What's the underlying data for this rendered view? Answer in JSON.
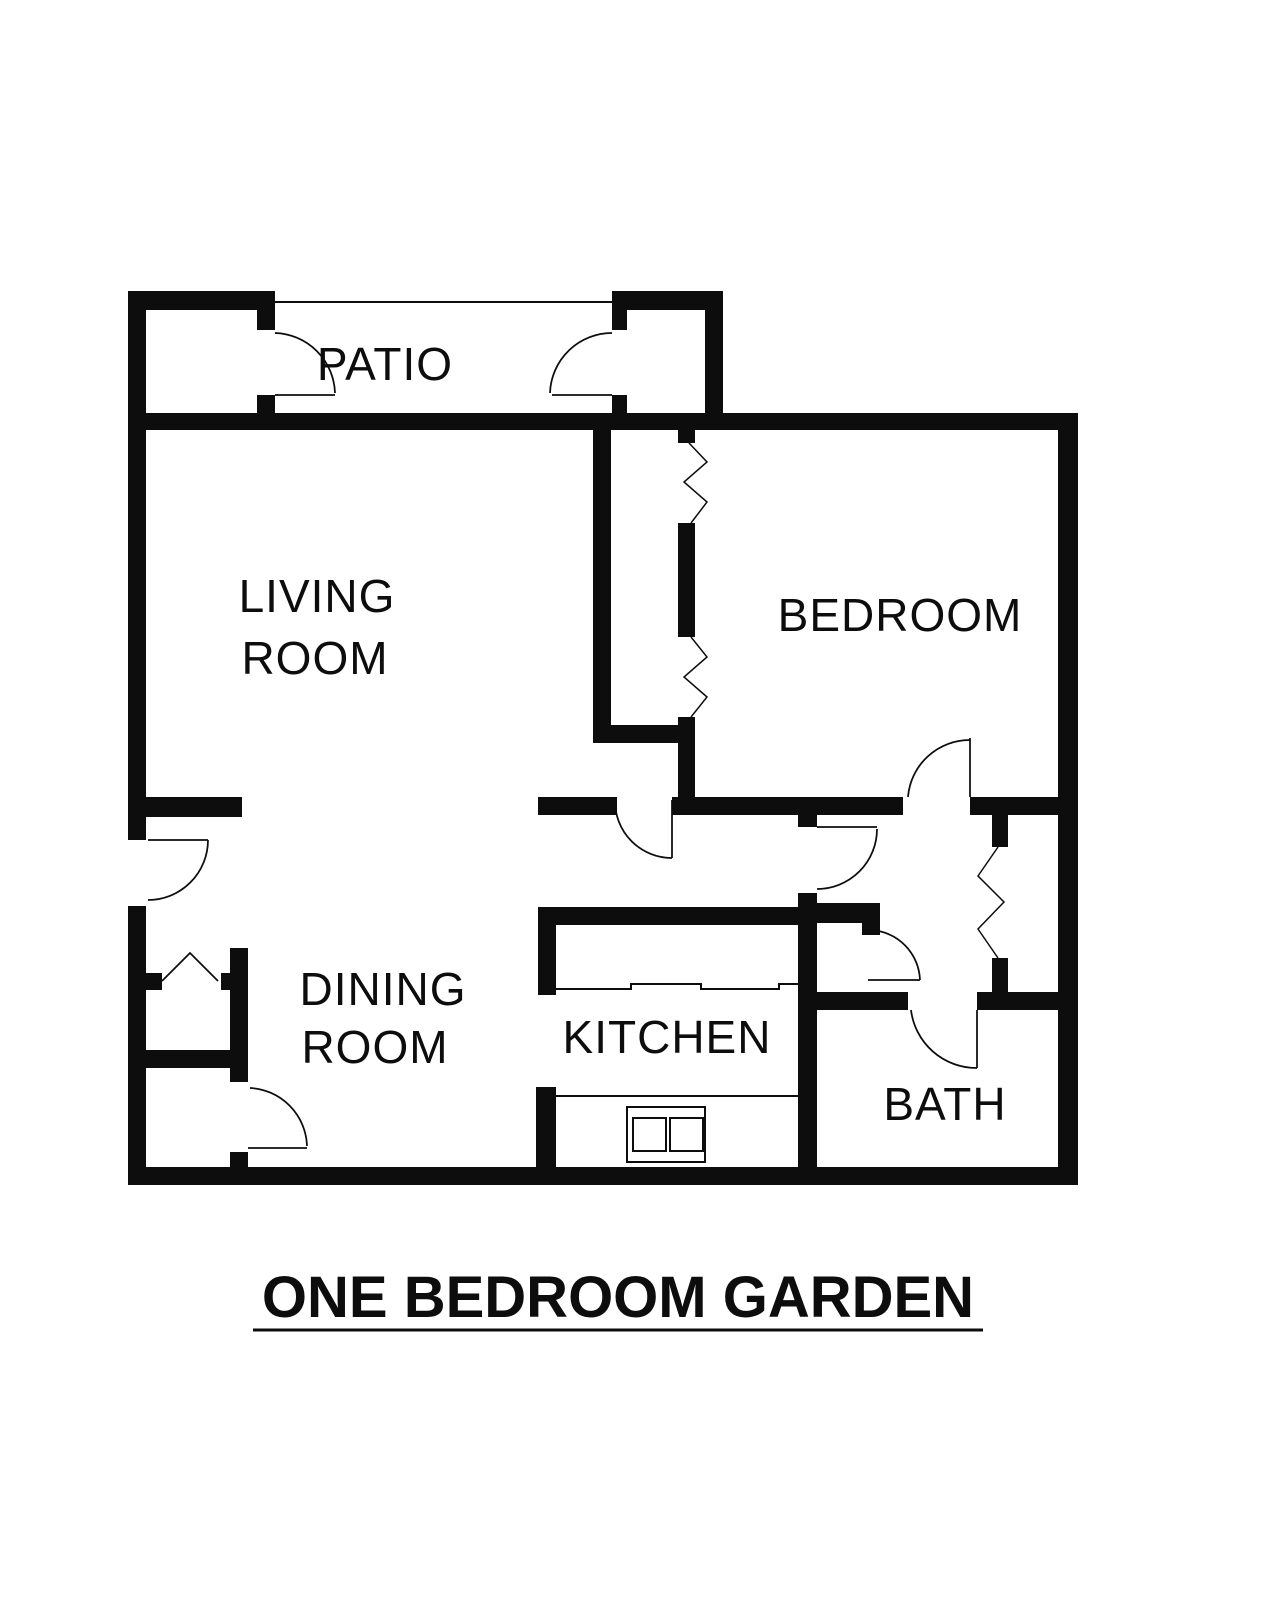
{
  "document": {
    "type": "apartment-floor-plan",
    "title": "ONE BEDROOM GARDEN",
    "colors": {
      "wall": "#0d0d0d",
      "background": "#ffffff"
    },
    "rooms": {
      "patio": "PATIO",
      "living_line1": "LIVING",
      "living_line2": "ROOM",
      "bedroom": "BEDROOM",
      "dining_line1": "DINING",
      "dining_line2": "ROOM",
      "kitchen": "KITCHEN",
      "bath": "BATH"
    },
    "features": [
      "patio-storage-closet-left",
      "patio-storage-closet-right",
      "patio-open-edge",
      "entry-door",
      "coat-closet-bifold-doors",
      "utility-closet-door",
      "living-room-hall-door",
      "bedroom-closet-accordion-doors",
      "bedroom-door",
      "hall-closet-door",
      "linen-closet-accordion-door",
      "bath-door",
      "kitchen-counter-with-sink",
      "kitchen-range"
    ]
  }
}
